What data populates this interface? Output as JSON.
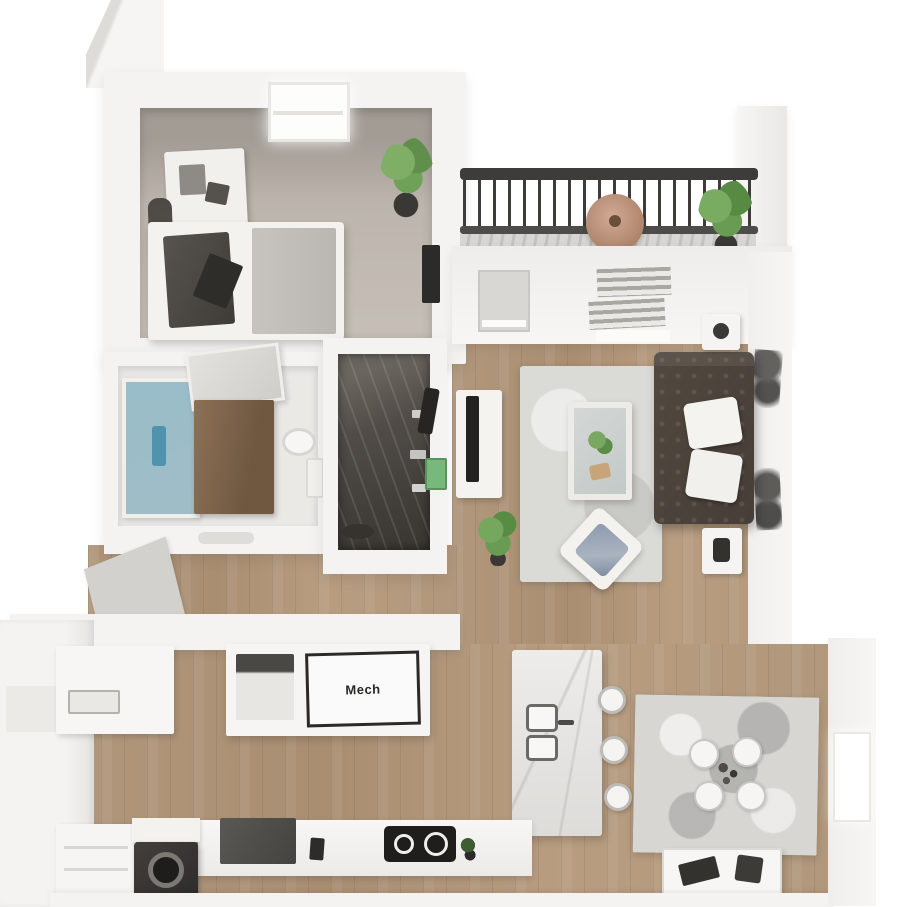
{
  "scene": {
    "kind": "floorplan-3d-render",
    "description": "Top-down 3D rendering of a one-bedroom apartment with balcony"
  },
  "labels": {
    "mech": "Mech"
  },
  "rooms": [
    {
      "id": "bedroom"
    },
    {
      "id": "bathroom"
    },
    {
      "id": "walk-in-closet"
    },
    {
      "id": "living-room"
    },
    {
      "id": "balcony"
    },
    {
      "id": "kitchen"
    },
    {
      "id": "dining-area"
    },
    {
      "id": "entry"
    },
    {
      "id": "mech-closet"
    }
  ],
  "furniture": {
    "bedroom": [
      "bed",
      "duvet",
      "throw-blanket",
      "dresser",
      "clothes-rack",
      "wall-tv",
      "potted-plant",
      "window"
    ],
    "bathroom": [
      "glass-shower",
      "wood-vanity",
      "leaning-mirror",
      "toilet"
    ],
    "walk-in-closet": [
      "hanging-clothes",
      "shelves",
      "storage-bowl",
      "green-storage-box"
    ],
    "living-room": [
      "tufted-sofa",
      "throw-pillows",
      "area-rug",
      "glass-coffee-table",
      "tv-stand",
      "tv",
      "side-table-lamp-north",
      "side-table-lamp-south",
      "accent-chair",
      "floor-plant",
      "wall-art",
      "patio-door",
      "window-blinds"
    ],
    "balcony": [
      "metal-railing",
      "round-table",
      "potted-plant",
      "deck-boards"
    ],
    "kitchen": [
      "upper-cabinets",
      "mech-closet-door",
      "water-heater",
      "island-with-sink",
      "bar-stools",
      "cooktop",
      "washer",
      "lower-cabinets",
      "counter-plant"
    ],
    "dining-area": [
      "mottled-rug",
      "dining-table",
      "four-round-chairs",
      "console-desk",
      "laptop",
      "side-window"
    ]
  },
  "palette": {
    "bg": "#ffffff",
    "wall": "#f4f3f1",
    "wall-edge": "#dedcd8",
    "bedroom-floor": "#c6bfb7",
    "wood": "#b1977b",
    "rug": "#dadad6",
    "sofa": "#463e37",
    "railing": "#3d3c3a",
    "shower": "#8ab5c4",
    "vanity": "#8d7155",
    "plant-a": "#7fae67",
    "plant-b": "#5f8f4b",
    "pot": "#3a3835",
    "closet-dark": "#4e4a45",
    "green-box": "#79b87c",
    "marble": "#edecea",
    "appliance": "#2a2928",
    "stool-border": "#bdbbb7",
    "mat": "#d3d1cd",
    "label-ink": "#2b2a28"
  }
}
